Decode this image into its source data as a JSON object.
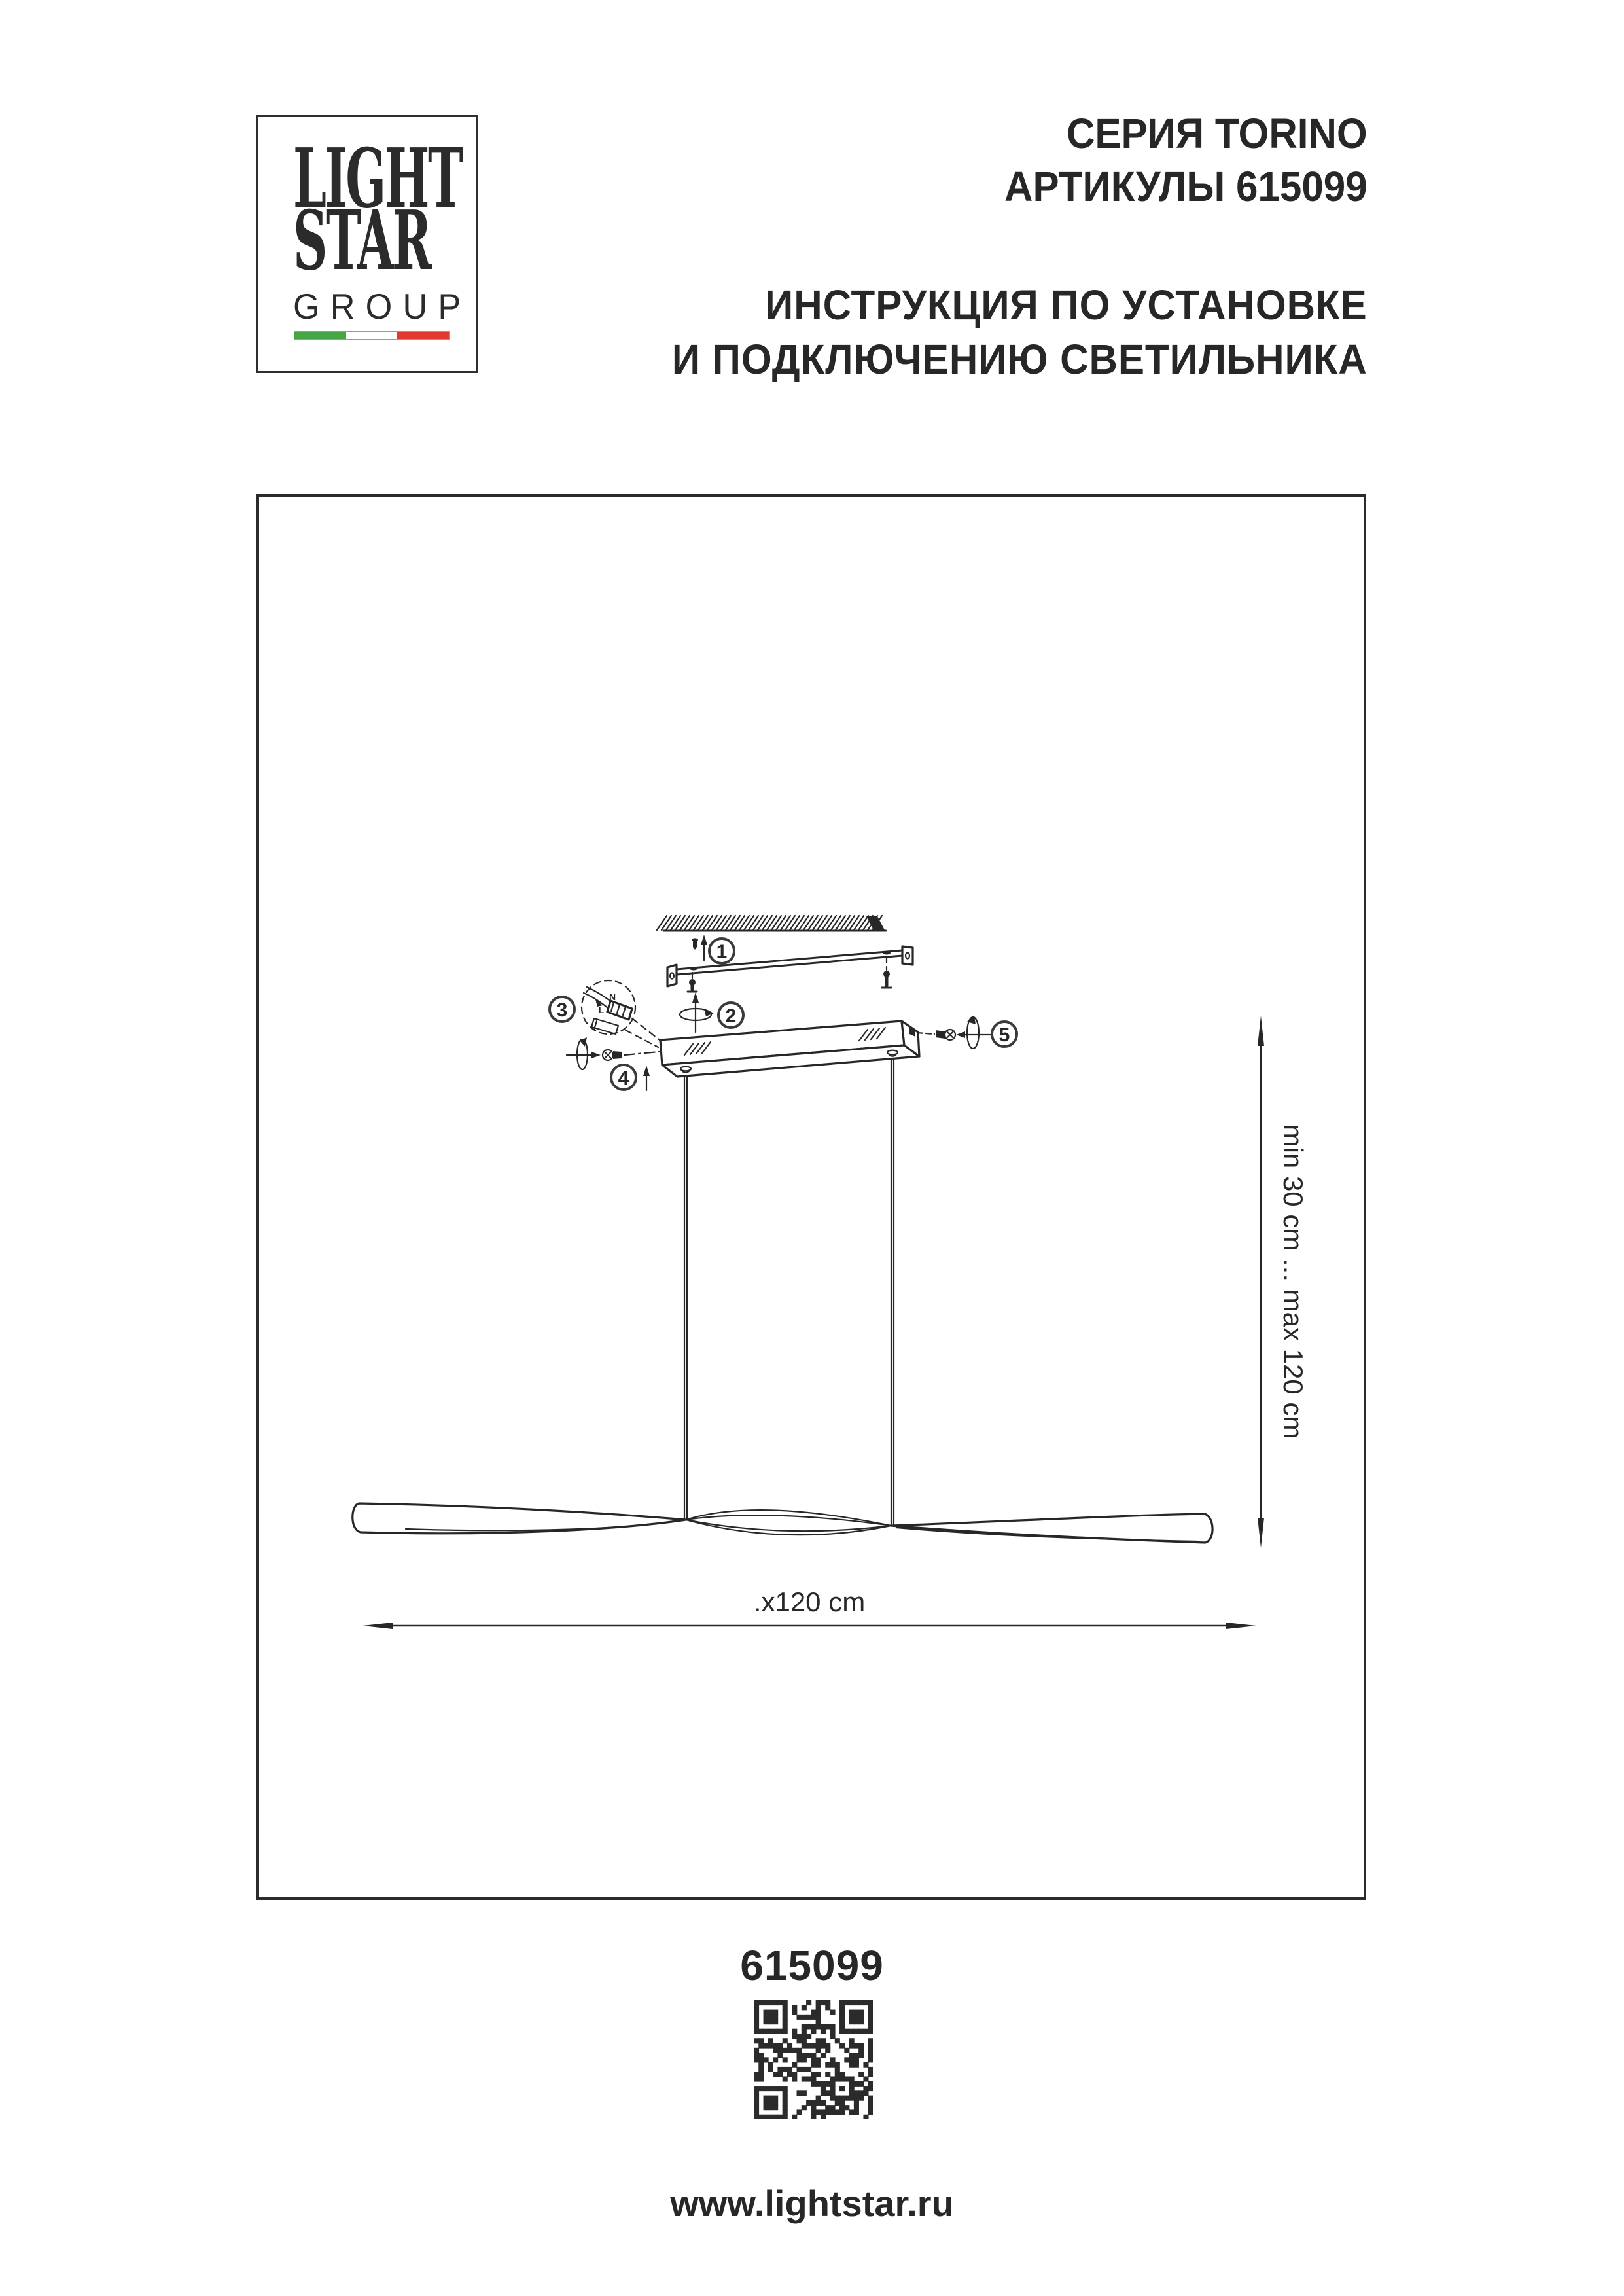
{
  "page": {
    "bg": "#ffffff",
    "ink": "#272727"
  },
  "logo": {
    "line1": "LIGHT",
    "line2": "STAR",
    "line3": "GROUP",
    "flag_green": "#44a546",
    "flag_white": "#ffffff",
    "flag_red": "#e23a2e"
  },
  "header": {
    "series": "СЕРИЯ TORINO",
    "articles": "АРТИКУЛЫ 615099",
    "instr1": "ИНСТРУКЦИЯ ПО УСТАНОВКЕ",
    "instr2": "И ПОДКЛЮЧЕНИЮ СВЕТИЛЬНИКА"
  },
  "diagram": {
    "callouts": [
      "1",
      "2",
      "3",
      "4",
      "5"
    ],
    "terminal": {
      "n": "N",
      "l": "L"
    },
    "dims": {
      "vertical": "min 30 cm ... max 120 cm",
      "horizontal": ".x120 cm"
    }
  },
  "footer": {
    "article": "615099",
    "website": "www.lightstar.ru"
  }
}
